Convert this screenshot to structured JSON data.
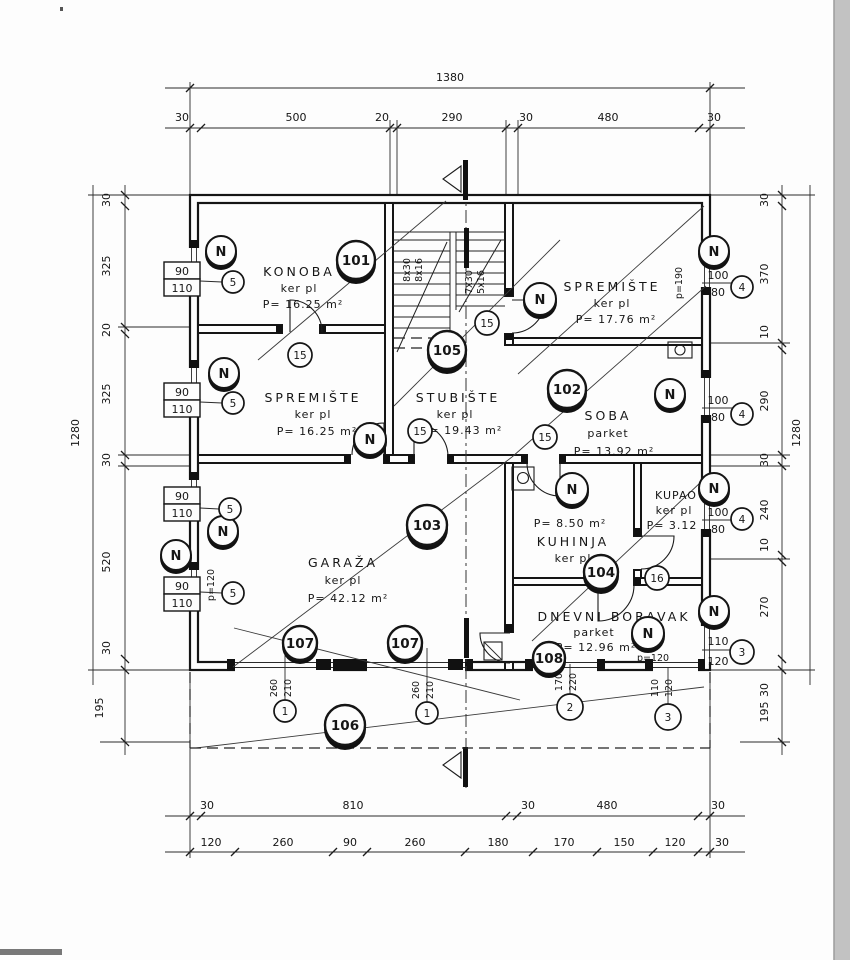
{
  "drawing": {
    "dim_top": {
      "overall": "1380",
      "seg": [
        "30",
        "500",
        "20",
        "290",
        "30",
        "480",
        "30"
      ]
    },
    "dim_bottom": {
      "outer": [
        "30",
        "810",
        "30",
        "480",
        "30"
      ],
      "inner": [
        "120",
        "260",
        "90",
        "260",
        "180",
        "170",
        "150",
        "120",
        "30"
      ]
    },
    "dim_left": {
      "overall": "1280",
      "seg": [
        "30",
        "325",
        "20",
        "325",
        "30",
        "520",
        "30"
      ],
      "extra": "195"
    },
    "dim_right": {
      "overall": "1280",
      "seg": [
        "30",
        "370",
        "10",
        "290",
        "30",
        "240",
        "10",
        "270",
        "30"
      ],
      "extra": "195"
    },
    "rooms": {
      "konoba": {
        "name": "KONOBA",
        "finish": "ker pl",
        "area": "P= 16.25 m²"
      },
      "spremiste1": {
        "name": "SPREMIŠTE",
        "finish": "ker pl",
        "area": "P= 17.76 m²"
      },
      "spremiste2": {
        "name": "SPREMIŠTE",
        "finish": "ker pl",
        "area": "P= 16.25 m²"
      },
      "stubiste": {
        "name": "STUBIŠTE",
        "finish": "ker pl",
        "area": "P= 19.43 m²"
      },
      "soba": {
        "name": "SOBA",
        "finish": "parket",
        "area": "P= 13.92 m²"
      },
      "garaza": {
        "name": "GARAŽA",
        "finish": "ker pl",
        "area": "P= 42.12 m²"
      },
      "kuhinja": {
        "name": "KUHINJA",
        "finish": "ker pl",
        "area": "P= 8.50 m²"
      },
      "kupao": {
        "name": "KUPAO",
        "finish": "ker pl",
        "area": "P= 3.12"
      },
      "dnevni": {
        "name": "DNEVNI BORAVAK",
        "finish": "parket",
        "area": "P= 12.96 m²"
      }
    },
    "tags": {
      "t101": "101",
      "t102": "102",
      "t103": "103",
      "t104": "104",
      "t105": "105",
      "t106": "106",
      "t107": "107",
      "t108": "108",
      "n": "N",
      "k1": "1",
      "k2": "2",
      "k3": "3",
      "k4": "4",
      "k5": "5",
      "k15": "15",
      "k16": "16"
    },
    "win": {
      "w90": "90",
      "w110": "110",
      "w100": "100",
      "w80": "80",
      "w120": "120"
    },
    "door": {
      "d260": "260",
      "d210": "210",
      "d170": "170",
      "d220": "220",
      "d110": "110",
      "d120": "120"
    },
    "parapet": {
      "p190": "p=190",
      "p120": "p=120"
    },
    "stairs": {
      "l1": "8x30",
      "l2": "8x16",
      "r1": "7x30",
      "r2": "5x16"
    }
  }
}
